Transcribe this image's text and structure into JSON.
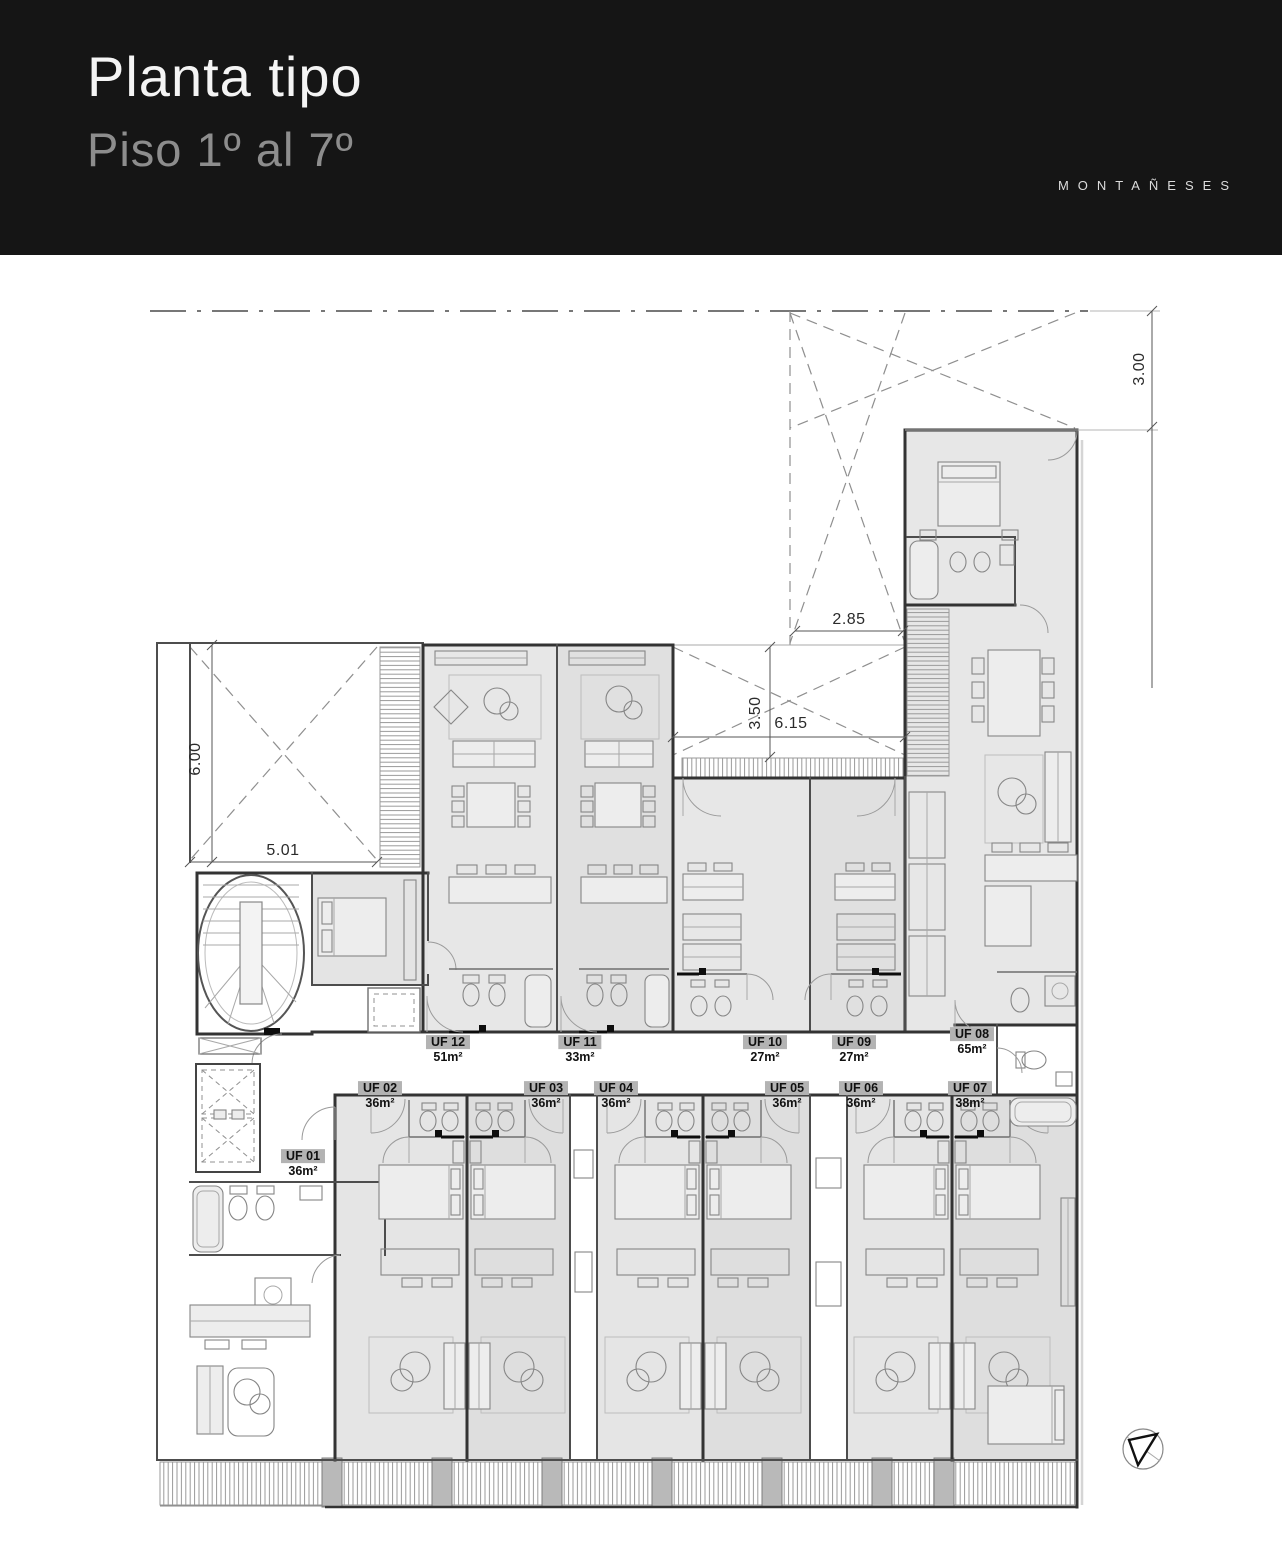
{
  "header": {
    "title": "Planta tipo",
    "subtitle": "Piso 1º al 7º",
    "brand": "MONTAÑESES"
  },
  "units": [
    {
      "id": "UF 01",
      "area": "36m²"
    },
    {
      "id": "UF 02",
      "area": "36m²"
    },
    {
      "id": "UF 03",
      "area": "36m²"
    },
    {
      "id": "UF 04",
      "area": "36m²"
    },
    {
      "id": "UF 05",
      "area": "36m²"
    },
    {
      "id": "UF 06",
      "area": "36m²"
    },
    {
      "id": "UF 07",
      "area": "38m²"
    },
    {
      "id": "UF 08",
      "area": "65m²"
    },
    {
      "id": "UF 09",
      "area": "27m²"
    },
    {
      "id": "UF 10",
      "area": "27m²"
    },
    {
      "id": "UF 11",
      "area": "33m²"
    },
    {
      "id": "UF 12",
      "area": "51m²"
    }
  ],
  "dimensions": [
    {
      "value": "3.00"
    },
    {
      "value": "2.85"
    },
    {
      "value": "3.50"
    },
    {
      "value": "6.15"
    },
    {
      "value": "6.00"
    },
    {
      "value": "5.01"
    }
  ],
  "icons": {
    "north_arrow": "north-arrow-triangle"
  },
  "colors": {
    "header_bg": "#151515",
    "room_fill": "#e7e7e7",
    "room_fill_alt": "#dedede",
    "label_chip": "#b3b3b3"
  }
}
